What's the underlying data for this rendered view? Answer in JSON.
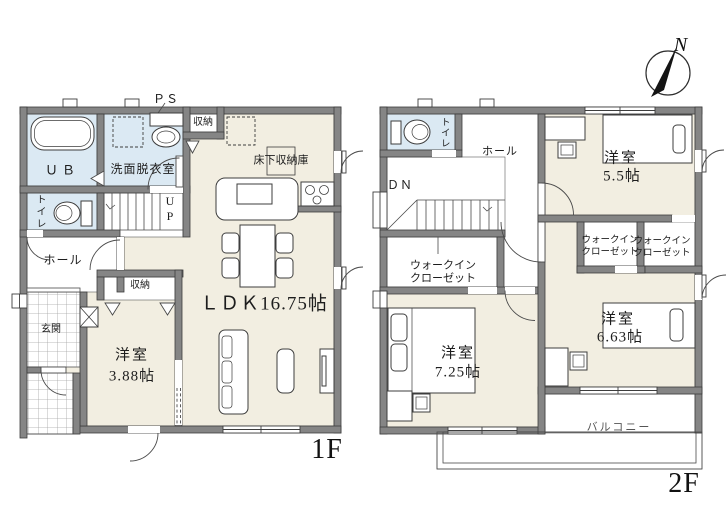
{
  "compass": {
    "label": "N"
  },
  "floor1": {
    "label": "1F",
    "rooms": {
      "ub": "ＵＢ",
      "washroom": "洗面脱衣室",
      "pipe_space": "ＰＳ",
      "storage_kitchen": "収納",
      "underfloor_storage": "床下収納庫",
      "toilet": "トイレ",
      "stairs_up": "UP",
      "hall": "ホール",
      "entrance": "玄関",
      "bedroom_closet": "収納",
      "bedroom": {
        "name": "洋室",
        "size": "3.88帖"
      },
      "ldk": {
        "label": "ＬＤＫ16.75帖"
      }
    }
  },
  "floor2": {
    "label": "2F",
    "rooms": {
      "toilet": "トイレ",
      "hall": "ホール",
      "stairs_down": "ＤＮ",
      "bedroom_a": {
        "name": "洋室",
        "size": "5.5帖"
      },
      "bedroom_b": {
        "name": "洋室",
        "size": "7.25帖"
      },
      "bedroom_c": {
        "name": "洋室",
        "size": "6.63帖"
      },
      "balcony": "バルコニー",
      "walk_in_closets": [
        {
          "line1": "ウォークイン",
          "line2": "クローゼット"
        },
        {
          "line1": "ウォークイン",
          "line2": "クローゼット"
        },
        {
          "line1": "ウォークイン",
          "line2": "クローゼット"
        }
      ]
    }
  },
  "colors": {
    "floor": "#f2eee1",
    "wet_area": "#dbe9f3",
    "wall": "#858585",
    "outline": "#3d3d3d"
  }
}
